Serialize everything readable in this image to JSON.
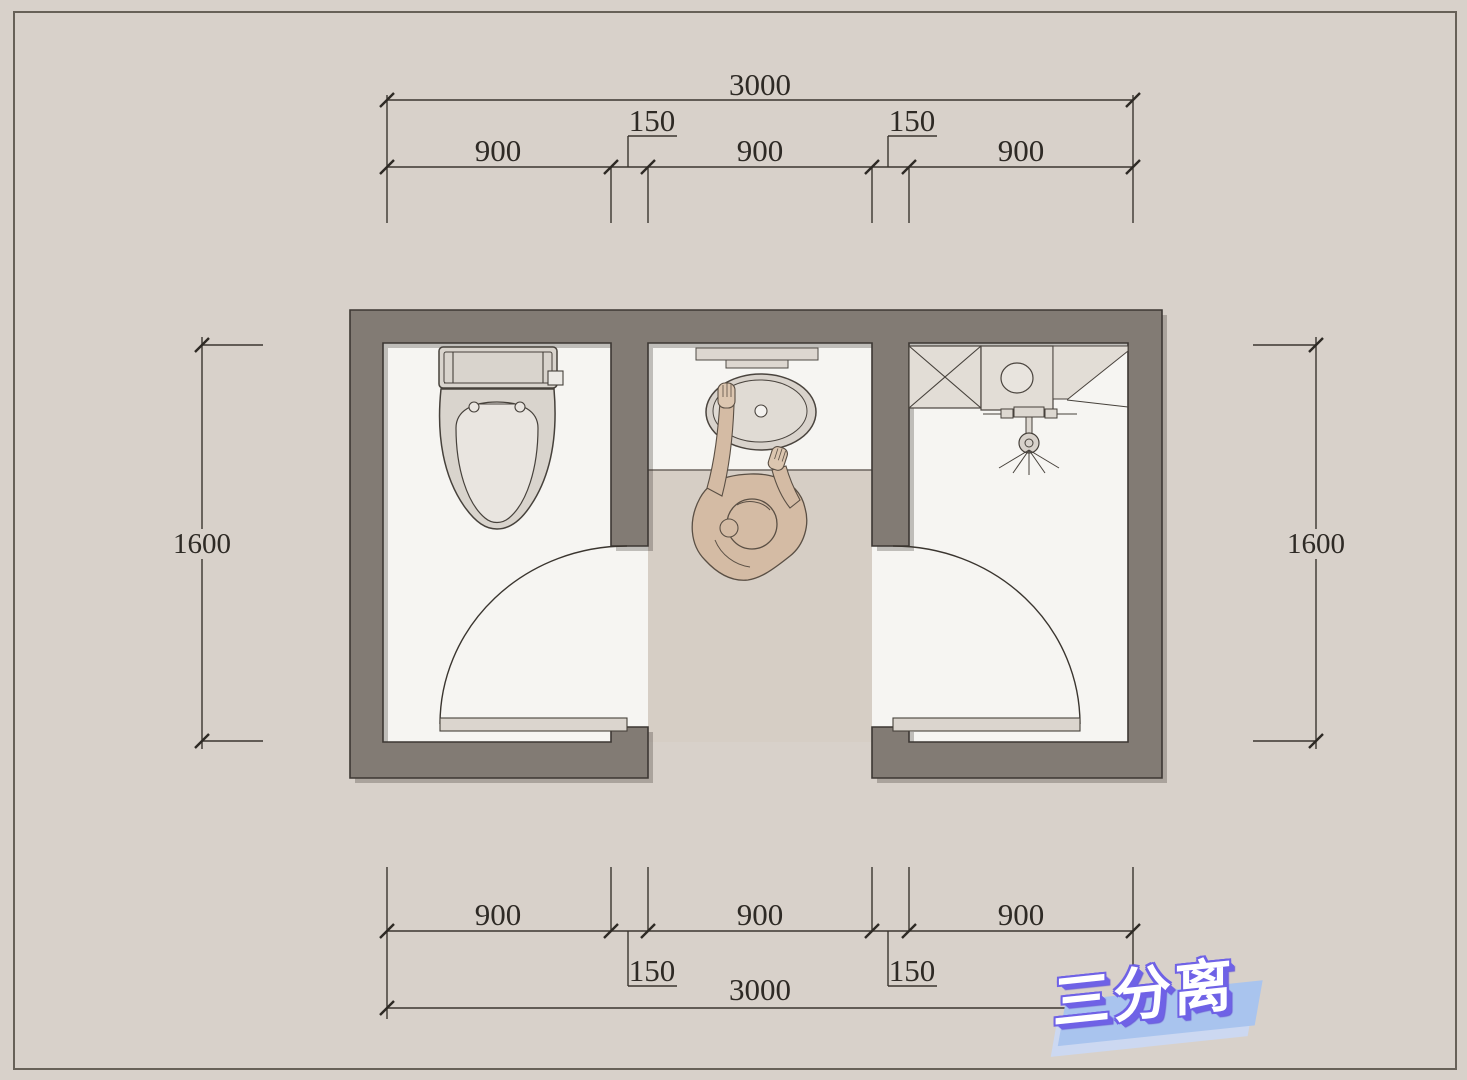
{
  "title": {
    "text": "三分离"
  },
  "dimensions": {
    "top": {
      "overall": "3000",
      "left": "900",
      "center": "900",
      "right": "900",
      "inset_left": "150",
      "inset_right": "150"
    },
    "bottom": {
      "overall": "3000",
      "left": "900",
      "center": "900",
      "right": "900",
      "inset_left": "150",
      "inset_right": "150"
    },
    "left_side": {
      "height": "1600"
    },
    "right_side": {
      "height": "1600"
    }
  },
  "colors": {
    "canvas": "#d8d1ca",
    "wall": "#827b74",
    "room_floor": "#f6f5f2",
    "corridor_floor": "#d6cec5",
    "fixture_fill": "#ddd8d1",
    "line": "#46413b",
    "logo_purple": "#6f62e6",
    "logo_blue": "#a9c4ee"
  }
}
